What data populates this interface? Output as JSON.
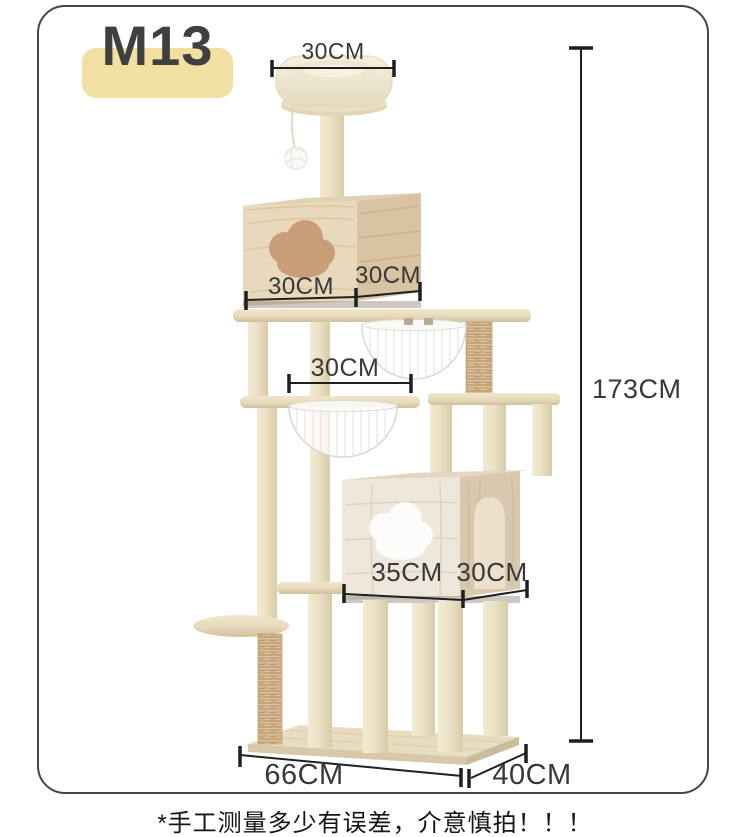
{
  "badge": {
    "label": "M13"
  },
  "dimensions": {
    "top_perch_width": "30CM",
    "upper_house_width": "30CM",
    "upper_house_depth": "30CM",
    "middle_platform_width": "30CM",
    "total_height": "173CM",
    "lower_house_width": "35CM",
    "lower_house_depth": "30CM",
    "base_length": "66CM",
    "base_depth": "40CM"
  },
  "footnote": {
    "text": "*手工测量多少有误差，介意慎拍！！！"
  },
  "colors": {
    "badge_background": "#F2DFA2",
    "badge_text": "#3E4040",
    "wood_light": "#EDE3C8",
    "wood_grain": "#D3BD97",
    "sisal": "#D9BC93",
    "dimension_line": "#1F1F1F",
    "dimension_text": "#383838",
    "card_border": "#454545"
  }
}
